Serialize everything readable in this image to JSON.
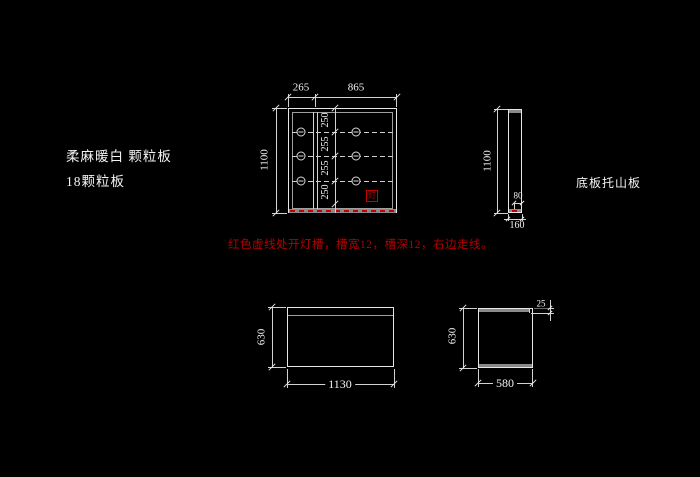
{
  "labels": {
    "material_line1": "柔麻暖白 颗粒板",
    "material_line2": "18颗粒板",
    "side_panel_label": "底板托山板",
    "red_note": "红色虚线处开灯槽，槽宽12，槽深12，右边走线。",
    "lamp_mark": "灯"
  },
  "front_view": {
    "dim_top_left": "265",
    "dim_top_right": "865",
    "dim_height": "1100",
    "row_dims": [
      "250",
      "255",
      "255",
      "250"
    ]
  },
  "side_view": {
    "dim_height": "1100",
    "dim_groove_offset": "80",
    "dim_depth": "160"
  },
  "bottom_left_view": {
    "dim_height": "630",
    "dim_width": "1130"
  },
  "bottom_right_view": {
    "dim_height": "630",
    "dim_width": "580",
    "dim_corner": "25"
  },
  "colors": {
    "background": "#000000",
    "line": "#e6e6e6",
    "edge_band": "#8a8a8a",
    "groove_red": "#c40000",
    "note_red": "#b30000"
  }
}
